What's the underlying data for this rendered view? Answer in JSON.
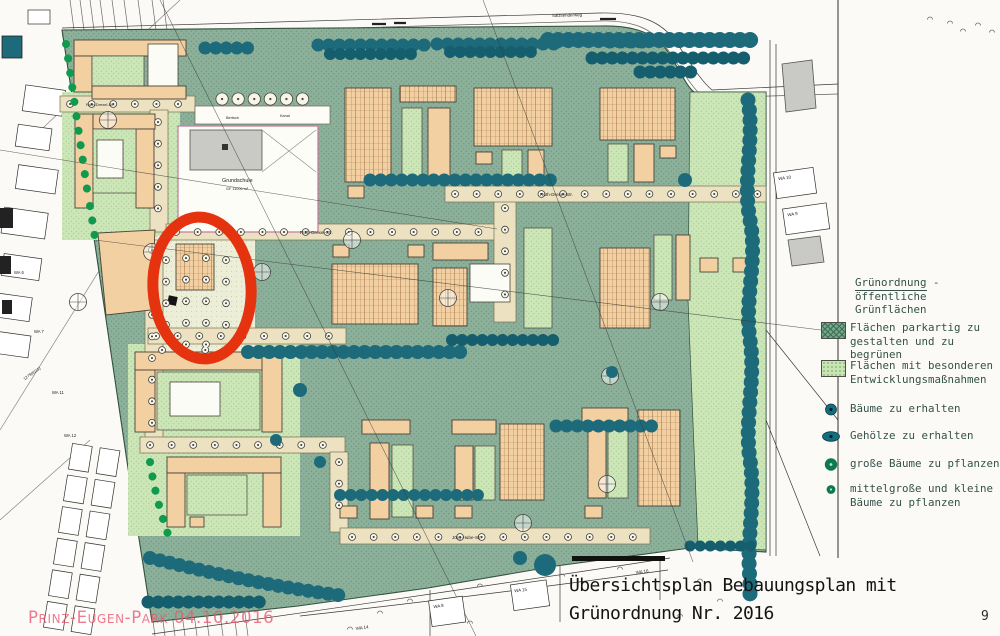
{
  "page": {
    "title_line1": "Übersichtsplan Bebauungsplan mit",
    "title_line2": "Grünordnung Nr. 2016",
    "page_number": "9",
    "watermark": "Prinz-Eugen-Park 04.10.2016"
  },
  "legend": {
    "heading_word": "Grünordnung",
    "heading_rest": " - öffentliche",
    "heading_line2": "Grünflächen",
    "items": [
      {
        "icon": "dark-green-area-swatch",
        "line1": "Flächen parkartig zu",
        "line2": "gestalten und zu begrünen",
        "color": "#74a78a"
      },
      {
        "icon": "light-green-area-swatch",
        "line1": "Flächen mit besonderen",
        "line2": "Entwicklungsmaßnahmen",
        "color": "#c8e5b3"
      },
      {
        "icon": "tree-preserve-dot",
        "line1": "Bäume zu erhalten",
        "line2": "",
        "color": "#1d6a7b"
      },
      {
        "icon": "shrub-preserve-dot",
        "line1": "Gehölze zu erhalten",
        "line2": "",
        "color": "#1d6a7b"
      },
      {
        "icon": "large-tree-plant-dot",
        "line1": "große Bäume zu pflanzen",
        "line2": "",
        "color": "#0c7a4b"
      },
      {
        "icon": "small-tree-plant-dot",
        "line1": "mittelgroße und kleine",
        "line2": "Bäume zu pflanzen",
        "color": "#0c7a4b"
      }
    ]
  },
  "map": {
    "labels": {
      "salzsenderweg": "Salzsenderweg",
      "ruth_drexel": "Ruth-Drexel-Str.",
      "joerg_hube": "Jörg-Hube-Str.",
      "grundschule": "Grundschule",
      "gf_area": "GF 11000 m²",
      "bertsch": "Bertsch",
      "kanal": "Kanal",
      "wa6": "WA 6",
      "wa7": "WA 7",
      "wa11": "WA 11",
      "wa12": "WA 12",
      "plot_1279": "1279(8111)",
      "wa10": "WA 10",
      "wa9": "WA 9",
      "wa8": "WA 8",
      "wa15": "WA 15",
      "wa14": "WA 14",
      "wa16": "WA 16"
    }
  },
  "colors": {
    "annotation_red": "#e5330f",
    "park_green": "#8cb09a",
    "development_green": "#cce6b8",
    "tree_teal": "#1d6a7b",
    "preserve_dot_green": "#0f9a4e",
    "building_tan": "#f3d0a2",
    "watermark_pink": "#e95a73"
  }
}
